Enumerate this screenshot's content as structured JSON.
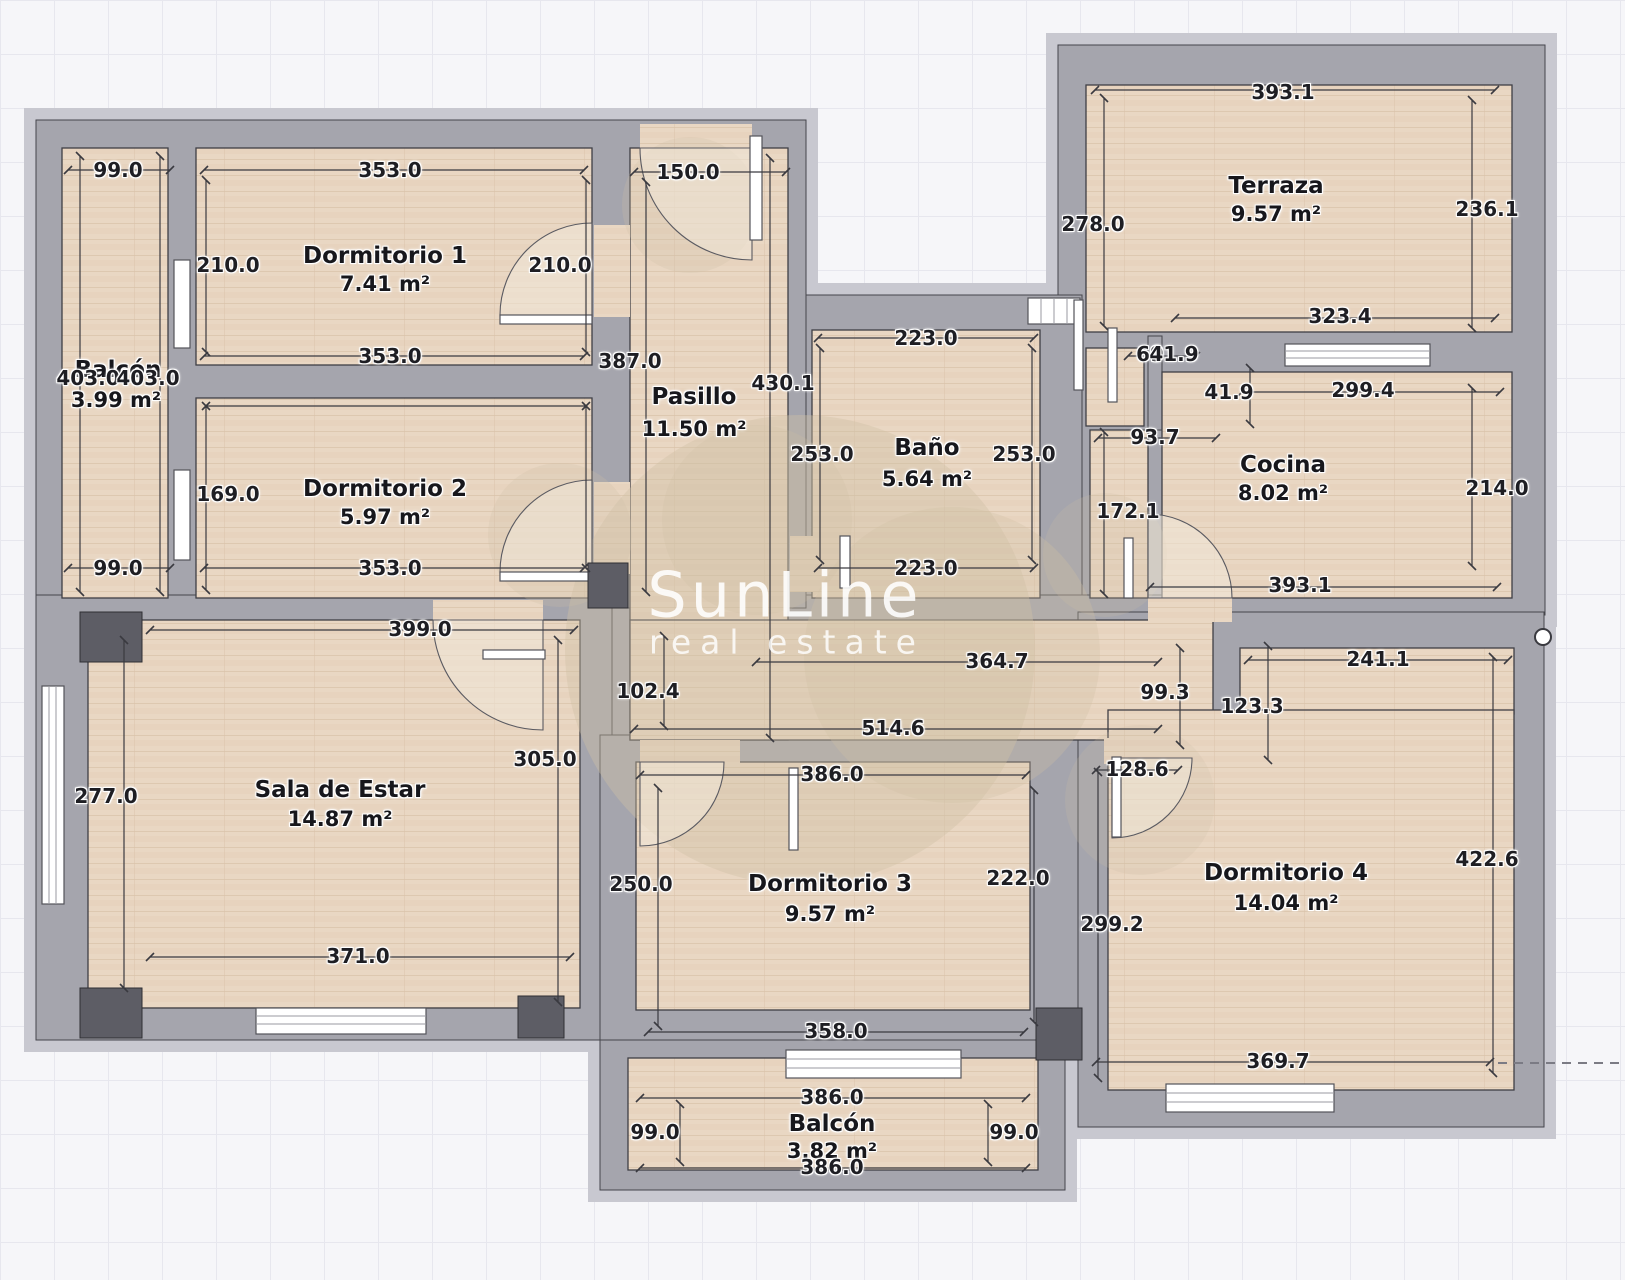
{
  "watermark": {
    "line1": "SunLine",
    "line2": "real estate"
  },
  "rooms": [
    {
      "id": "balcon-izquierdo",
      "name": "Balcón",
      "area": "3.99 m²"
    },
    {
      "id": "dormitorio-1",
      "name": "Dormitorio 1",
      "area": "7.41 m²"
    },
    {
      "id": "dormitorio-2",
      "name": "Dormitorio 2",
      "area": "5.97 m²"
    },
    {
      "id": "pasillo",
      "name": "Pasillo",
      "area": "11.50 m²"
    },
    {
      "id": "bano",
      "name": "Baño",
      "area": "5.64 m²"
    },
    {
      "id": "terraza",
      "name": "Terraza",
      "area": "9.57 m²"
    },
    {
      "id": "cocina",
      "name": "Cocina",
      "area": "8.02 m²"
    },
    {
      "id": "sala-de-estar",
      "name": "Sala de Estar",
      "area": "14.87 m²"
    },
    {
      "id": "dormitorio-3",
      "name": "Dormitorio 3",
      "area": "9.57 m²"
    },
    {
      "id": "dormitorio-4",
      "name": "Dormitorio 4",
      "area": "14.04 m²"
    },
    {
      "id": "balcon-inferior",
      "name": "Balcón",
      "area": "3.82 m²"
    }
  ],
  "dims": [
    "99.0",
    "353.0",
    "150.0",
    "210.0",
    "210.0",
    "403.0",
    "403.0",
    "387.0",
    "430.1",
    "169.0",
    "353.0",
    "353.0",
    "99.0",
    "223.0",
    "253.0",
    "253.0",
    "223.0",
    "393.1",
    "278.0",
    "236.1",
    "323.4",
    "69",
    "41.9",
    "41.9",
    "299.4",
    "93.7",
    "172.1",
    "214.0",
    "393.1",
    "364.7",
    "102.4",
    "99.3",
    "514.6",
    "399.0",
    "277.0",
    "305.0",
    "371.0",
    "386.0",
    "250.0",
    "222.0",
    "358.0",
    "241.1",
    "123.3",
    "128.6",
    "299.2",
    "422.6",
    "369.7",
    "386.0",
    "99.0",
    "99.0",
    "386.0"
  ],
  "colors": {
    "wall": "#a5a5ad",
    "floor": "#e9d7c3",
    "line": "#3a3a40",
    "pillar": "#5d5d65",
    "watermark_blob": "#cfc0a6"
  }
}
